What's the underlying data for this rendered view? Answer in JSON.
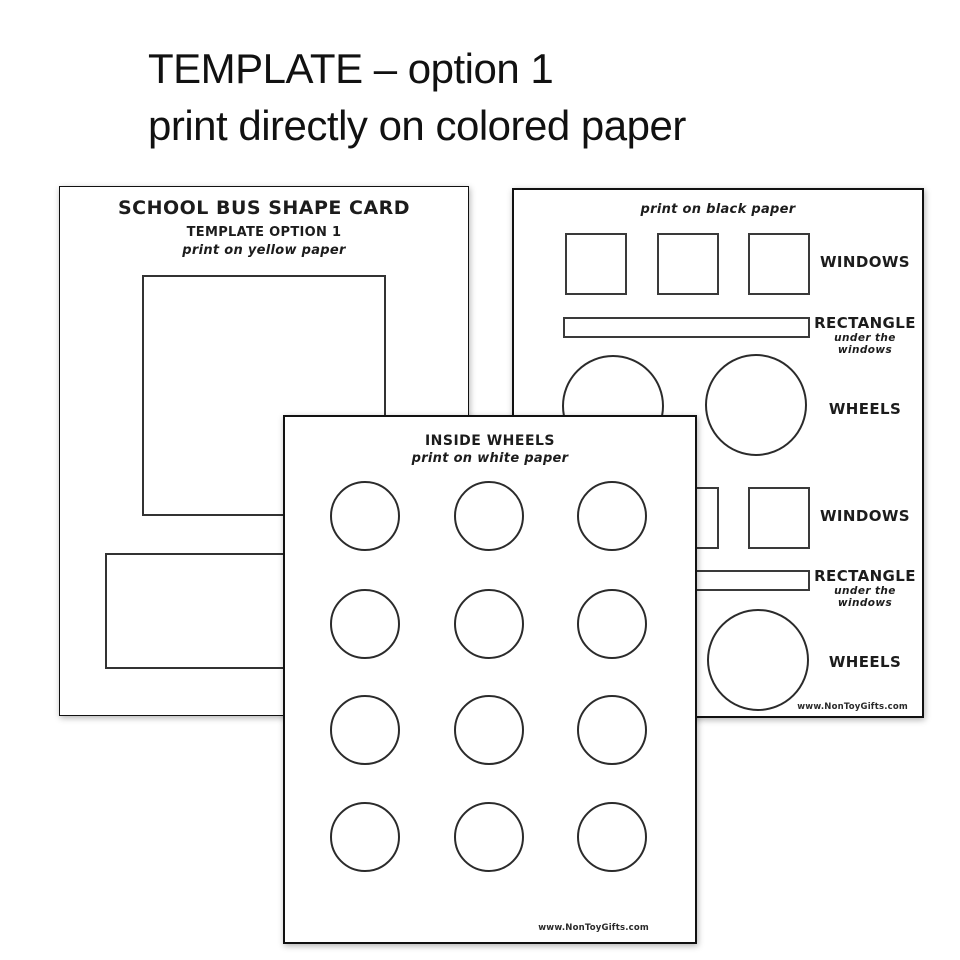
{
  "header": {
    "title_line1": "TEMPLATE – option 1",
    "title_line2": "print directly on colored paper"
  },
  "yellow_page": {
    "title": "SCHOOL BUS SHAPE CARD",
    "subtitle": "TEMPLATE OPTION 1",
    "print_note": "print on yellow paper"
  },
  "black_page": {
    "print_note": "print on black paper",
    "windows_label_top": "WINDOWS",
    "rectangle_label_top": "RECTANGLE",
    "rectangle_sub_top": "under the windows",
    "wheels_label_top": "WHEELS",
    "windows_label_bottom": "WINDOWS",
    "rectangle_label_bottom": "RECTANGLE",
    "rectangle_sub_bottom": "under the windows",
    "wheels_label_bottom": "WHEELS",
    "website": "www.NonToyGifts.com"
  },
  "white_page": {
    "title": "INSIDE WHEELS",
    "print_note": "print on white paper",
    "website": "www.NonToyGifts.com"
  }
}
